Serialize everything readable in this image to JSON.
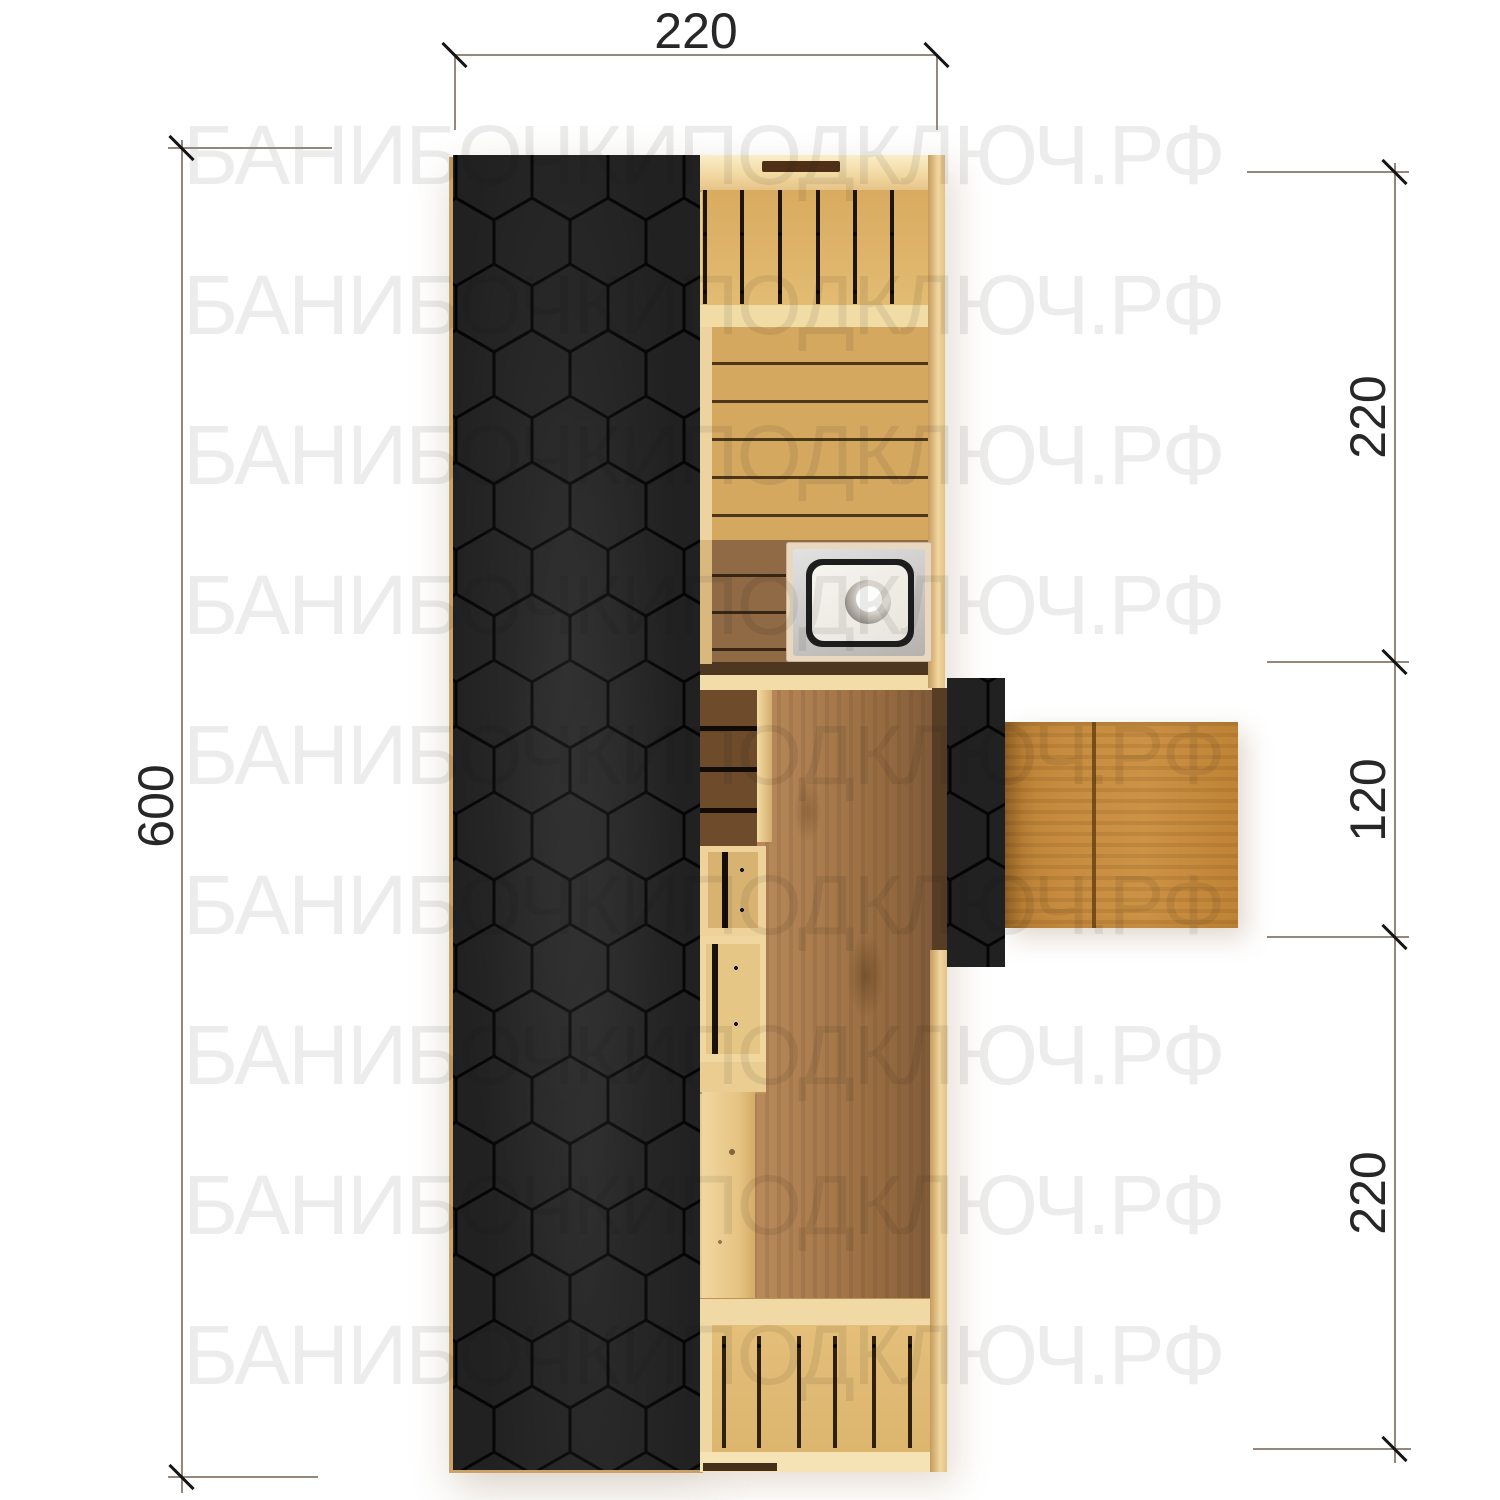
{
  "watermark": {
    "text": "БАНИБОЧКИПОДКЛЮЧ.РФ"
  },
  "dimensions": {
    "top": {
      "label": "220"
    },
    "left": {
      "label": "600"
    },
    "right": [
      {
        "label": "220"
      },
      {
        "label": "120"
      },
      {
        "label": "220"
      }
    ]
  },
  "colors": {
    "roof_black": "#212121",
    "hex_outline": "#050505",
    "wall_light_wood": "#f2dda8",
    "bench_wood": "#dcb268",
    "floor_plank": "#d5a860",
    "sink_room_plank": "#8f6a45",
    "rest_room_floor": "#a3754a",
    "deck_wood": "#c78c3f",
    "sink_steel": "#c9c9c9",
    "dimension_line": "#95887b",
    "dimension_text": "#272727",
    "watermark_gray": "#ececec"
  }
}
